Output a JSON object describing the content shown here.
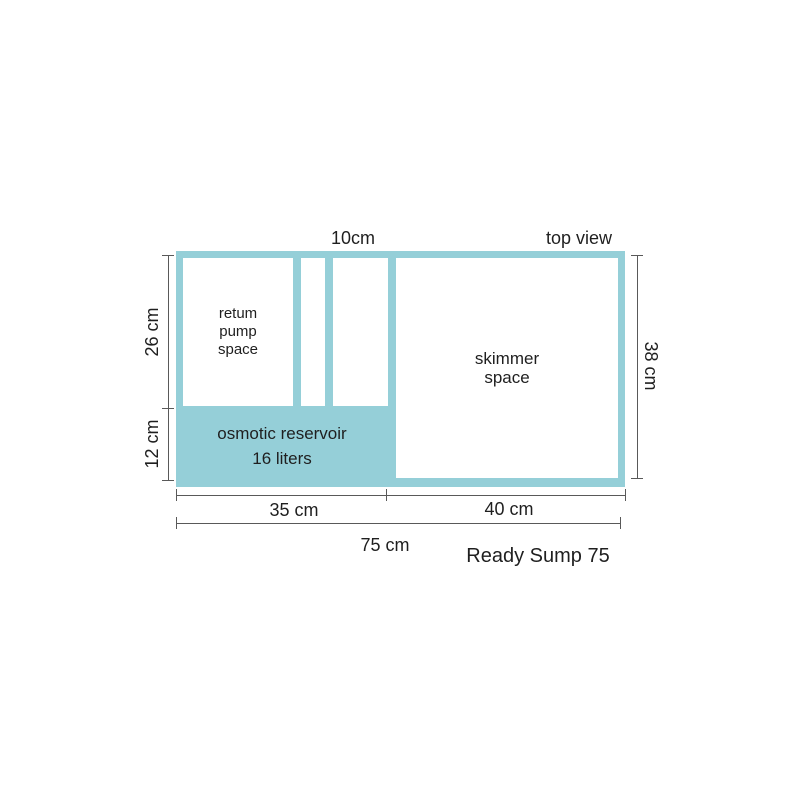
{
  "diagram": {
    "product_name": "Ready Sump 75",
    "view_label": "top view",
    "colors": {
      "tank_fill": "#95cfd8",
      "dimension_line": "#595959",
      "text": "#1f1f1f",
      "background": "#ffffff"
    },
    "compartments": {
      "return_pump": "retum\npump\nspace",
      "skimmer": "skimmer\nspace",
      "reservoir_name": "osmotic reservoir",
      "reservoir_volume": "16 liters"
    },
    "dimensions": {
      "channel_width": "10cm",
      "left_upper": "26 cm",
      "left_lower": "12 cm",
      "right_height": "38 cm",
      "bottom_left": "35 cm",
      "bottom_right": "40 cm",
      "bottom_total": "75 cm"
    }
  }
}
